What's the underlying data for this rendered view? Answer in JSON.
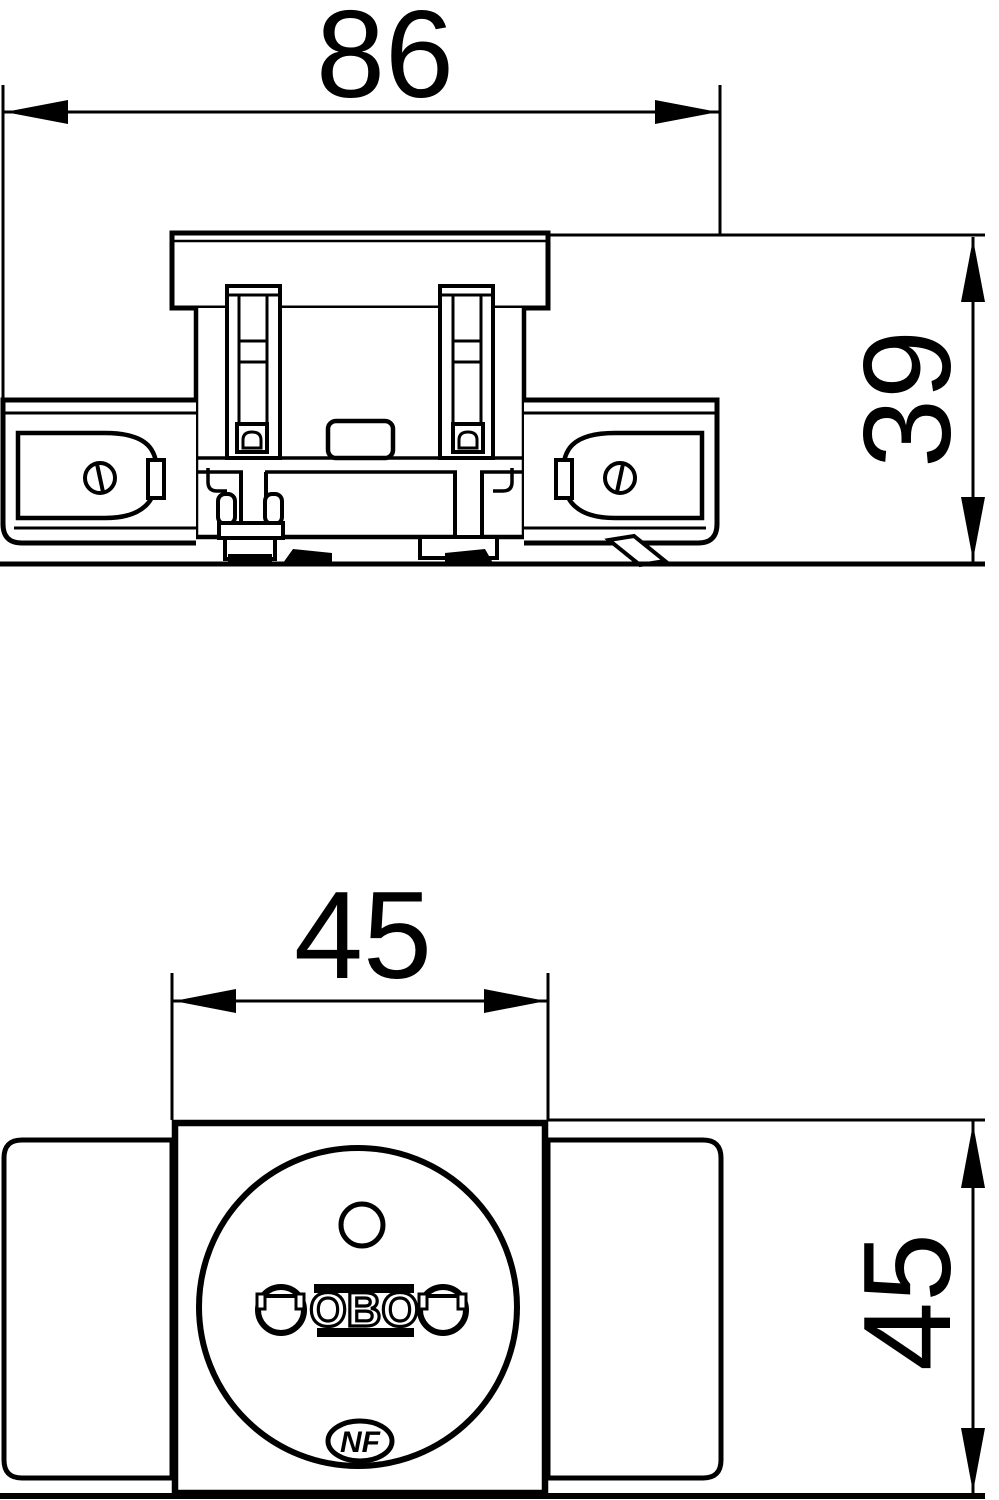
{
  "drawing_type": "technical-dimension-drawing",
  "colors": {
    "line": "#000000",
    "background": "#ffffff"
  },
  "side_view": {
    "name": "side elevation of socket module",
    "width_label": "86",
    "height_label": "39"
  },
  "front_view": {
    "name": "front view of socket module",
    "width_label": "45",
    "height_label": "45",
    "socket_logo": "OBO",
    "certification_mark": "NF"
  }
}
